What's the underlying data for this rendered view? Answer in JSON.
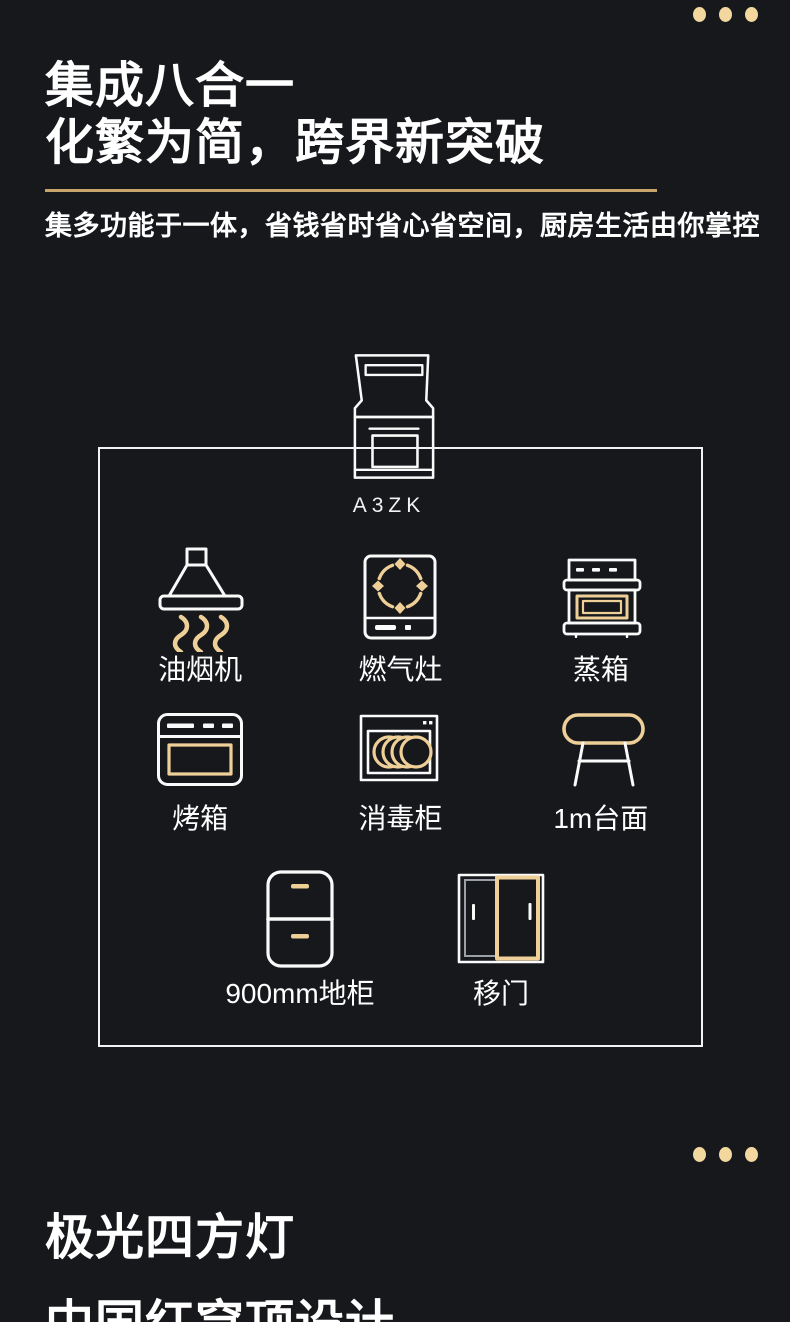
{
  "theme": {
    "bg": "#16181c",
    "ink": "#ffffff",
    "stroke_white": "#fafafa",
    "gold": "#efcf98",
    "gold_dots": "#f2d79f",
    "gold_divider": "#c8a56b",
    "panel_gray": "#9aa0a6"
  },
  "hero": {
    "title_line1": "集成八合一",
    "title_line2": "化繁为简，跨界新突破",
    "subtitle": "集多功能于一体，省钱省时省心省空间，厨房生活由你掌控"
  },
  "product": {
    "model": "A3ZK",
    "icon": "integrated-stove-icon"
  },
  "features": [
    {
      "label": "油烟机",
      "icon": "range-hood-icon"
    },
    {
      "label": "燃气灶",
      "icon": "gas-stove-icon"
    },
    {
      "label": "蒸箱",
      "icon": "steam-oven-icon"
    },
    {
      "label": "烤箱",
      "icon": "oven-icon"
    },
    {
      "label": "消毒柜",
      "icon": "disinfection-cabinet-icon"
    },
    {
      "label": "1m台面",
      "icon": "countertop-icon"
    },
    {
      "label": "900mm地柜",
      "icon": "base-cabinet-icon"
    },
    {
      "label": "移门",
      "icon": "sliding-door-icon"
    }
  ],
  "footer": {
    "title_line1": "极光四方灯",
    "title_line2": "中国红穹顶设计"
  }
}
